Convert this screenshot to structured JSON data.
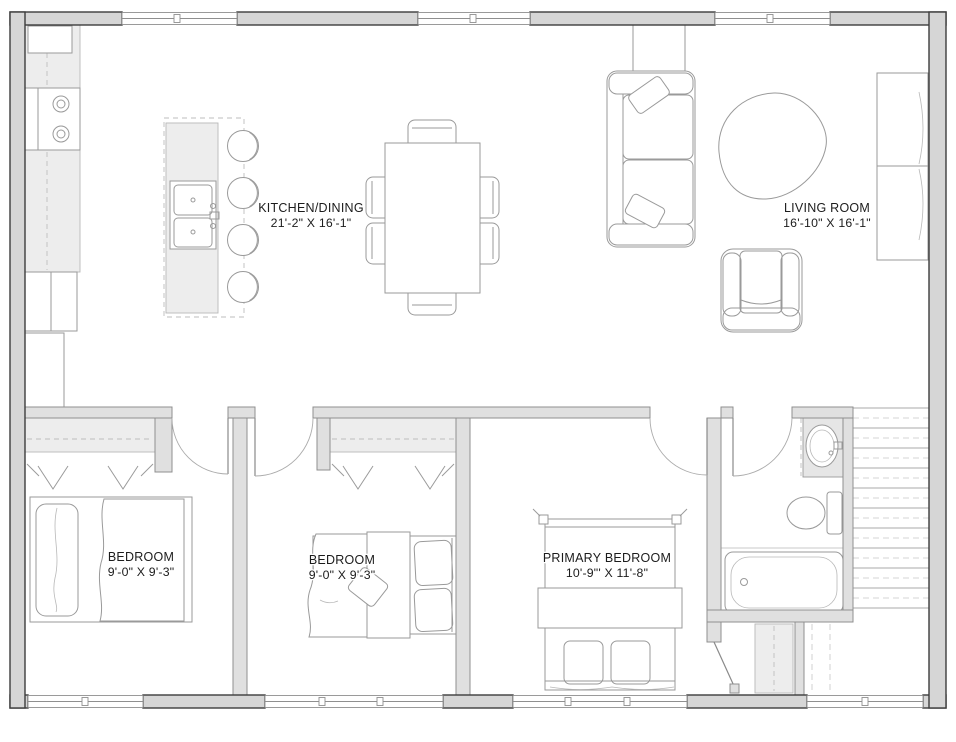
{
  "plan": {
    "rooms": [
      {
        "id": "kitchen-dining",
        "name": "KITCHEN/DINING",
        "dims": "21'-2\" X 16'-1\""
      },
      {
        "id": "living-room",
        "name": "LIVING ROOM",
        "dims": "16'-10\" X 16'-1\""
      },
      {
        "id": "bedroom-1",
        "name": "BEDROOM",
        "dims": "9'-0\" X 9'-3\""
      },
      {
        "id": "bedroom-2",
        "name": "BEDROOM",
        "dims": "9'-0\" X 9'-3\""
      },
      {
        "id": "primary-bedroom",
        "name": "PRIMARY BEDROOM",
        "dims": "10'-9\"' X 11'-8\""
      }
    ],
    "colors": {
      "wall_fill": "#d6d6d6",
      "wall_edge": "#3d3d3d",
      "interior_wall_fill": "#e0e0e0",
      "interior_wall_edge": "#8f8f8f",
      "furniture_line": "#9a9a9a",
      "fixture_fill": "#ededed",
      "dash_line": "#bdbdbd",
      "label_text": "#1c1c1c",
      "background": "#ffffff"
    }
  }
}
